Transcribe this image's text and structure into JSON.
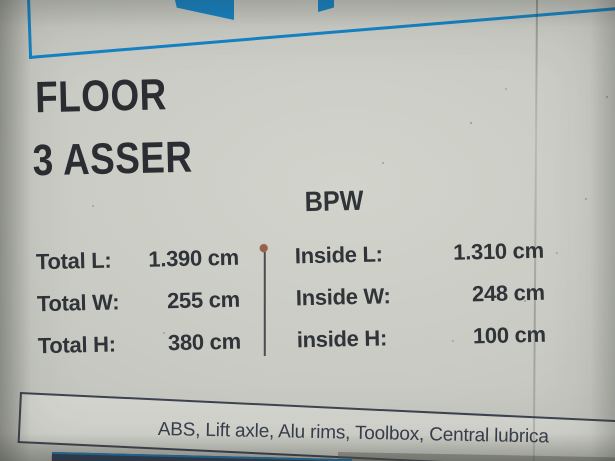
{
  "document": {
    "title": "FLOOR",
    "subtitle": "3 ASSER",
    "axle_brand": "BPW",
    "spec_table": {
      "left_rows": [
        {
          "label": "Total L:",
          "value": "1.390 cm"
        },
        {
          "label": "Total W:",
          "value": "255 cm"
        },
        {
          "label": "Total H:",
          "value": "380 cm"
        }
      ],
      "right_rows": [
        {
          "label": "Inside L:",
          "value": "1.310 cm"
        },
        {
          "label": "Inside W:",
          "value": "248 cm"
        },
        {
          "label": "inside H:",
          "value": "100 cm"
        }
      ]
    },
    "features_line": "ABS, Lift axle, Alu rims, Toolbox, Central lubrica"
  },
  "colors": {
    "accent_blue": "#1484c6",
    "heading_text": "#2b2d32",
    "table_text": "#303338",
    "features_text": "#3a3e4d",
    "bottom_bar_navy": "#2e3f58",
    "pin_brown": "#9a6047",
    "paper_background": "#c8cac3"
  },
  "icons": {
    "divider_pin": "round-dot"
  }
}
